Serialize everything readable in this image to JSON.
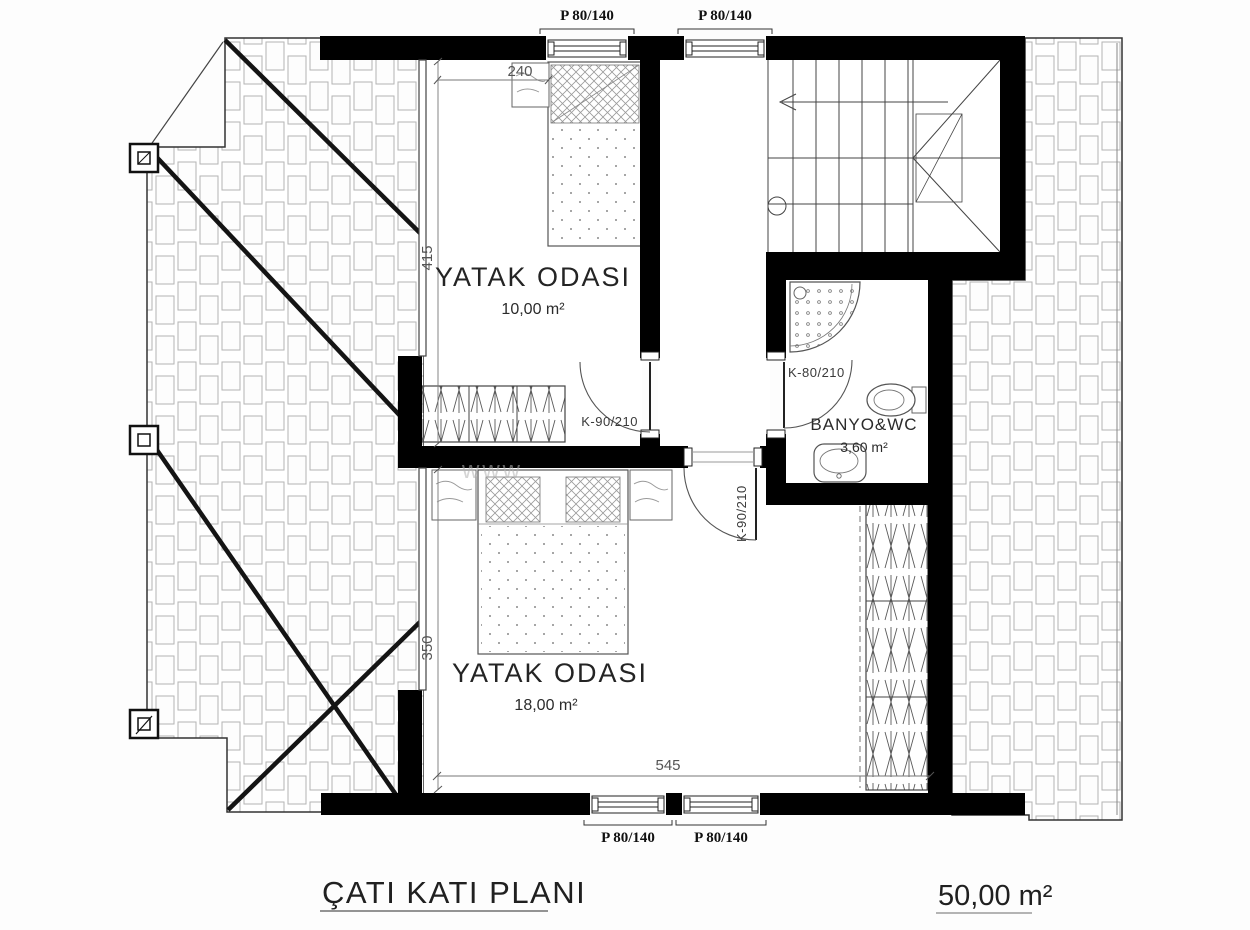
{
  "plan": {
    "title": "ÇATI KATI PLANI",
    "total_area": "50,00 m²"
  },
  "rooms": {
    "bedroom1": {
      "name": "YATAK ODASI",
      "area": "10,00 m²"
    },
    "bedroom2": {
      "name": "YATAK ODASI",
      "area": "18,00 m²"
    },
    "bathroom": {
      "name": "BANYO&WC",
      "area": "3,60 m²"
    }
  },
  "windows": {
    "top_left": "P 80/140",
    "top_right": "P 80/140",
    "bottom_left": "P 80/140",
    "bottom_right": "P 80/140"
  },
  "doors": {
    "bedroom1": "K-90/210",
    "bedroom2": "K-90/210",
    "bathroom": "K-80/210"
  },
  "dimensions": {
    "bed_width": "240",
    "bedroom1_depth": "415",
    "bedroom2_depth": "350",
    "bedroom2_width": "545"
  },
  "watermark": "www",
  "colors": {
    "wall": "#000000",
    "line": "#3a3a3a",
    "tile": "#b3b3b3",
    "text": "#1f1f1f"
  }
}
